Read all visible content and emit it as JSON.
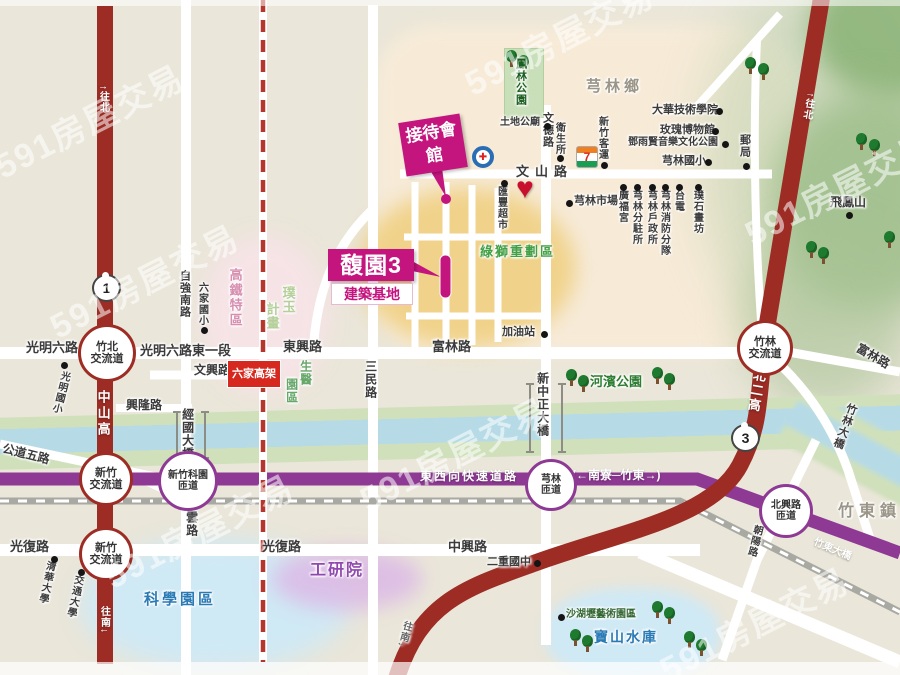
{
  "map": {
    "watermark_text": "591房屋交易",
    "colors": {
      "accent_magenta": "#c4157e",
      "highway_red": "#9d2c24",
      "expressway_purple": "#8e3a94",
      "hsr_red": "#b5362c",
      "park_green": "#2e7d32",
      "water_blue": "#b7dbe6",
      "tech_blue": "#2a7ab5"
    },
    "project": {
      "name": "馥園3",
      "subtitle": "建築基地",
      "reception": "接待會館"
    },
    "station": {
      "label": "六家高架"
    },
    "shields": [
      {
        "n": "1",
        "x": 92,
        "y": 274
      },
      {
        "n": "3",
        "x": 731,
        "y": 424
      }
    ],
    "interchanges": [
      {
        "lines": [
          "竹北",
          "交流道"
        ],
        "x": 78,
        "y": 324,
        "type": "red",
        "d": 52,
        "s": 11
      },
      {
        "lines": [
          "新竹",
          "交流道"
        ],
        "x": 79,
        "y": 452,
        "type": "red",
        "d": 48,
        "s": 11
      },
      {
        "lines": [
          "新竹",
          "交流道"
        ],
        "x": 79,
        "y": 527,
        "type": "red",
        "d": 48,
        "s": 11
      },
      {
        "lines": [
          "新竹科園",
          "匝道"
        ],
        "x": 158,
        "y": 451,
        "type": "purple",
        "d": 54,
        "s": 10
      },
      {
        "lines": [
          "芎林",
          "匝道"
        ],
        "x": 525,
        "y": 459,
        "type": "purple",
        "d": 46,
        "s": 10
      },
      {
        "lines": [
          "北興路",
          "匝道"
        ],
        "x": 759,
        "y": 484,
        "type": "purple",
        "d": 48,
        "s": 10
      },
      {
        "lines": [
          "竹林",
          "交流道"
        ],
        "x": 737,
        "y": 320,
        "type": "red",
        "d": 50,
        "s": 11
      }
    ],
    "labels": [
      {
        "t": "光明六路",
        "x": 26,
        "y": 341,
        "s": 13
      },
      {
        "t": "光明六路東一段",
        "x": 140,
        "y": 344,
        "s": 13
      },
      {
        "t": "東興路",
        "x": 283,
        "y": 340,
        "s": 13
      },
      {
        "t": "富林路",
        "x": 432,
        "y": 340,
        "s": 13
      },
      {
        "t": "文興路",
        "x": 194,
        "y": 364,
        "s": 12
      },
      {
        "t": "興隆路",
        "x": 126,
        "y": 399,
        "s": 12
      },
      {
        "t": "光復路",
        "x": 10,
        "y": 540,
        "s": 13
      },
      {
        "t": "光復路",
        "x": 262,
        "y": 540,
        "s": 13
      },
      {
        "t": "中興路",
        "x": 448,
        "y": 540,
        "s": 13
      },
      {
        "t": "文山路",
        "x": 516,
        "y": 165,
        "s": 13,
        "ls": 6
      },
      {
        "t": "土地公廟",
        "x": 500,
        "y": 118,
        "s": 10
      },
      {
        "t": "加油站",
        "x": 502,
        "y": 327,
        "s": 11
      },
      {
        "t": "二重國中",
        "x": 487,
        "y": 557,
        "s": 11
      },
      {
        "t": "芎林市場",
        "x": 574,
        "y": 196,
        "s": 11
      },
      {
        "t": "大華技術學院",
        "x": 652,
        "y": 105,
        "s": 11
      },
      {
        "t": "玫瑰博物館",
        "x": 660,
        "y": 125,
        "s": 11
      },
      {
        "t": "鄧雨賢音樂文化公園",
        "x": 628,
        "y": 138,
        "s": 10
      },
      {
        "t": "芎林國小",
        "x": 662,
        "y": 156,
        "s": 11
      },
      {
        "t": "飛鳳山",
        "x": 830,
        "y": 196,
        "s": 12
      },
      {
        "t": "芎林鄉",
        "x": 586,
        "y": 79,
        "s": 15,
        "c": "#9b9588",
        "ls": 4
      },
      {
        "t": "竹東鎮",
        "x": 838,
        "y": 504,
        "s": 16,
        "c": "#9b9588",
        "ls": 5
      },
      {
        "t": "河濱公園",
        "x": 590,
        "y": 375,
        "s": 13,
        "c": "#2e7d32"
      },
      {
        "t": "綠獅重劃區",
        "x": 480,
        "y": 245,
        "s": 13,
        "c": "#43a047",
        "ls": 2
      },
      {
        "t": "科學園區",
        "x": 144,
        "y": 592,
        "s": 15,
        "c": "#2a7ab5",
        "ls": 3
      },
      {
        "t": "工研院",
        "x": 310,
        "y": 563,
        "s": 16,
        "c": "#9049ae",
        "ls": 2
      },
      {
        "t": "寶山水庫",
        "x": 594,
        "y": 630,
        "s": 14,
        "c": "#2a7ab5",
        "ls": 2
      },
      {
        "t": "沙湖壢藝術園區",
        "x": 566,
        "y": 610,
        "s": 10,
        "c": "#336633"
      },
      {
        "t": "東西向快速道路",
        "x": 420,
        "y": 470,
        "s": 12,
        "c": "#fff",
        "ls": 2,
        "nh": 1
      },
      {
        "t": "(←南寮─竹東→)",
        "x": 572,
        "y": 469,
        "s": 12,
        "c": "#fff",
        "nh": 1
      },
      {
        "t": "竹東大橋",
        "x": 812,
        "y": 545,
        "s": 10,
        "c": "#fff",
        "r": 23,
        "nh": 1
      },
      {
        "t": "富林路",
        "x": 855,
        "y": 350,
        "s": 12,
        "r": 30
      },
      {
        "t": "公道五路",
        "x": 2,
        "y": 448,
        "s": 12,
        "r": 14
      },
      {
        "t": "竹林大橋",
        "x": 838,
        "y": 402,
        "s": 11,
        "o": "v",
        "r": 20
      },
      {
        "t": "新中正大橋",
        "x": 536,
        "y": 372,
        "s": 12,
        "o": "v"
      },
      {
        "t": "經國大橋",
        "x": 181,
        "y": 408,
        "s": 12,
        "o": "v"
      },
      {
        "t": "慈雲路",
        "x": 185,
        "y": 498,
        "s": 12,
        "o": "v"
      },
      {
        "t": "三民路",
        "x": 364,
        "y": 360,
        "s": 12,
        "o": "v"
      },
      {
        "t": "文德路",
        "x": 541,
        "y": 112,
        "s": 11,
        "o": "v"
      },
      {
        "t": "衛生所",
        "x": 553,
        "y": 122,
        "s": 10,
        "o": "v"
      },
      {
        "t": "匯豐超市",
        "x": 495,
        "y": 186,
        "s": 10,
        "o": "v"
      },
      {
        "t": "朝陽路",
        "x": 748,
        "y": 524,
        "s": 10,
        "o": "v",
        "r": 14
      },
      {
        "t": "自強南路",
        "x": 178,
        "y": 270,
        "s": 11,
        "o": "v"
      },
      {
        "t": "六家國小",
        "x": 196,
        "y": 282,
        "s": 10,
        "o": "v"
      },
      {
        "t": "高鐵特區",
        "x": 228,
        "y": 268,
        "s": 13,
        "o": "v",
        "c": "#d78fb0",
        "ls": 2
      },
      {
        "t": "璞玉",
        "x": 281,
        "y": 286,
        "s": 13,
        "o": "v",
        "c": "#b5cf9a"
      },
      {
        "t": "計畫",
        "x": 265,
        "y": 302,
        "s": 13,
        "o": "v",
        "c": "#b5cf9a"
      },
      {
        "t": "生醫",
        "x": 299,
        "y": 360,
        "s": 12,
        "o": "v",
        "c": "#66a86a"
      },
      {
        "t": "園區",
        "x": 285,
        "y": 378,
        "s": 12,
        "o": "v",
        "c": "#66a86a"
      },
      {
        "t": "光明國小",
        "x": 54,
        "y": 370,
        "s": 10,
        "o": "v",
        "r": 14
      },
      {
        "t": "清華大學",
        "x": 40,
        "y": 560,
        "s": 10,
        "o": "v",
        "r": 12
      },
      {
        "t": "交通大學",
        "x": 68,
        "y": 574,
        "s": 10,
        "o": "v",
        "r": 12
      },
      {
        "t": "新竹客運",
        "x": 596,
        "y": 116,
        "s": 10,
        "o": "v"
      },
      {
        "t": "郵局",
        "x": 738,
        "y": 134,
        "s": 11,
        "o": "v"
      },
      {
        "t": "廣福宮",
        "x": 616,
        "y": 190,
        "s": 10,
        "o": "v"
      },
      {
        "t": "芎林分駐所",
        "x": 630,
        "y": 190,
        "s": 10,
        "o": "v"
      },
      {
        "t": "芎林戶政所",
        "x": 645,
        "y": 190,
        "s": 10,
        "o": "v"
      },
      {
        "t": "芎林消防分隊",
        "x": 658,
        "y": 190,
        "s": 10,
        "o": "v"
      },
      {
        "t": "台電",
        "x": 672,
        "y": 190,
        "s": 10,
        "o": "v"
      },
      {
        "t": "璞石畫坊",
        "x": 691,
        "y": 190,
        "s": 10,
        "o": "v"
      },
      {
        "t": "中山高",
        "x": 96,
        "y": 390,
        "s": 13,
        "o": "v",
        "c": "#fff",
        "ls": 3,
        "nh": 1
      },
      {
        "t": "北二高",
        "x": 749,
        "y": 368,
        "s": 13,
        "o": "v",
        "c": "#fff",
        "ls": 2,
        "r": 10,
        "nh": 1
      },
      {
        "t": "↑往北",
        "x": 97,
        "y": 85,
        "s": 10,
        "o": "v",
        "c": "#fff",
        "nh": 1
      },
      {
        "t": "↑往北",
        "x": 802,
        "y": 92,
        "s": 10,
        "o": "v",
        "c": "#fff",
        "r": 10,
        "nh": 1
      },
      {
        "t": "往南↓",
        "x": 98,
        "y": 606,
        "s": 10,
        "o": "v",
        "c": "#fff",
        "nh": 1
      },
      {
        "t": "往南↓",
        "x": 398,
        "y": 620,
        "s": 10,
        "o": "v",
        "c": "#666",
        "r": 16
      },
      {
        "t": "鳳林公園",
        "x": 514,
        "y": 58,
        "s": 11,
        "o": "v",
        "c": "#1b5e20"
      }
    ],
    "dots": [
      [
        544,
        123
      ],
      [
        541,
        331
      ],
      [
        534,
        560
      ],
      [
        566,
        200
      ],
      [
        716,
        108
      ],
      [
        712,
        128
      ],
      [
        722,
        141
      ],
      [
        705,
        159
      ],
      [
        846,
        212
      ],
      [
        557,
        155
      ],
      [
        501,
        180
      ],
      [
        201,
        327
      ],
      [
        61,
        362
      ],
      [
        51,
        556
      ],
      [
        78,
        569
      ],
      [
        601,
        162
      ],
      [
        743,
        163
      ],
      [
        620,
        184
      ],
      [
        634,
        184
      ],
      [
        649,
        184
      ],
      [
        662,
        184
      ],
      [
        676,
        184
      ],
      [
        695,
        184
      ],
      [
        558,
        614
      ]
    ],
    "trees": [
      [
        506,
        50
      ],
      [
        518,
        55
      ],
      [
        745,
        57
      ],
      [
        758,
        63
      ],
      [
        856,
        133
      ],
      [
        869,
        139
      ],
      [
        806,
        241
      ],
      [
        818,
        247
      ],
      [
        884,
        231
      ],
      [
        566,
        369
      ],
      [
        578,
        375
      ],
      [
        652,
        367
      ],
      [
        664,
        373
      ],
      [
        570,
        629
      ],
      [
        582,
        635
      ],
      [
        652,
        601
      ],
      [
        664,
        607
      ],
      [
        684,
        631
      ],
      [
        696,
        639
      ]
    ],
    "watermarks": [
      [
        -15,
        95
      ],
      [
        455,
        12
      ],
      [
        735,
        162
      ],
      [
        95,
        505
      ],
      [
        350,
        428
      ],
      [
        650,
        598
      ],
      [
        40,
        255
      ]
    ]
  }
}
